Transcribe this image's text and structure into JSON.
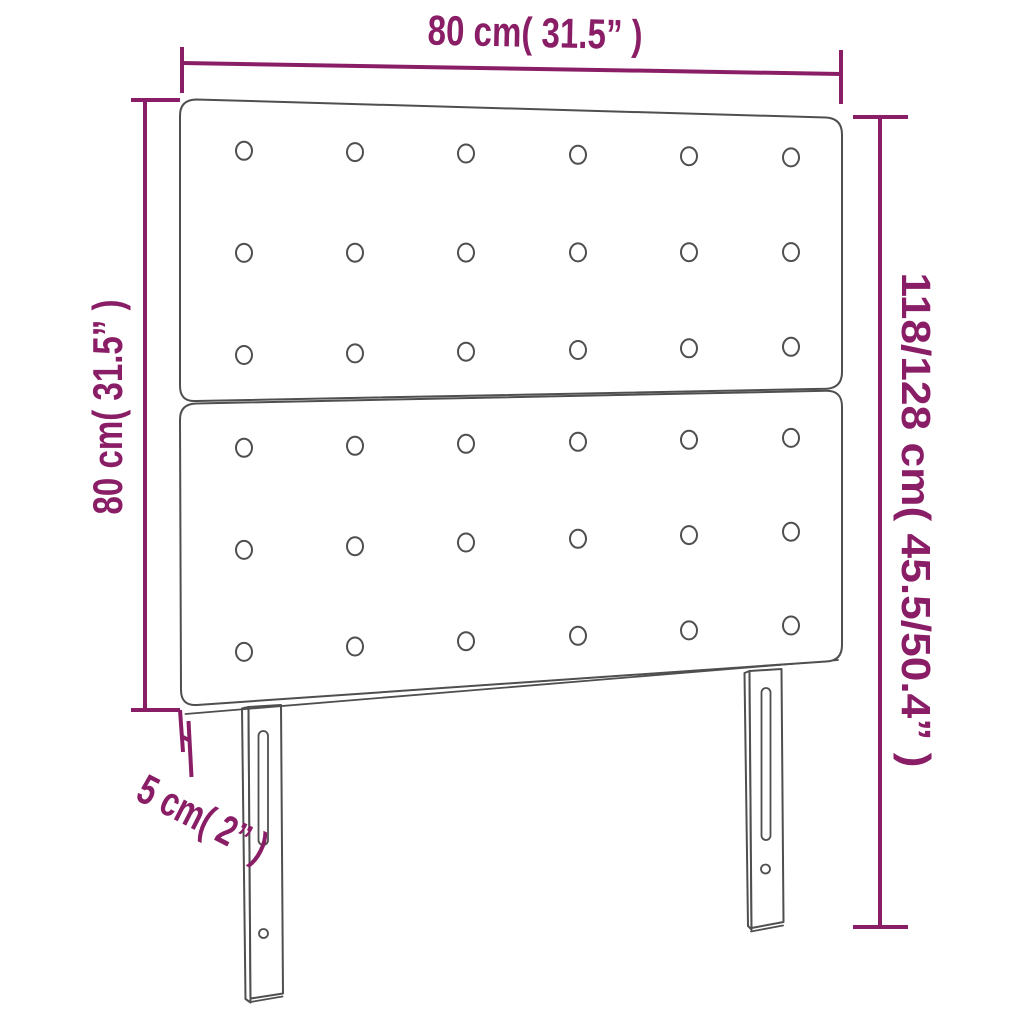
{
  "colors": {
    "dimension_accent": "#8a1e66",
    "outline": "#4f4f4f",
    "background": "#ffffff"
  },
  "dimensions": {
    "width": {
      "label": "80 cm( 31.5” )",
      "position": "top"
    },
    "panel_height": {
      "label": "80 cm( 31.5” )",
      "position": "left"
    },
    "total_height": {
      "label": "118/128 cm( 45.5/50.4” )",
      "position": "right"
    },
    "depth": {
      "label": "5 cm( 2” )",
      "position": "bottom-left"
    }
  },
  "headboard": {
    "panels": [
      {
        "name": "upper-panel",
        "button_rows": 3,
        "button_cols": 6,
        "buttons": 18
      },
      {
        "name": "lower-panel",
        "button_rows": 3,
        "button_cols": 6,
        "buttons": 18
      }
    ],
    "legs": [
      {
        "name": "left-leg",
        "slot": "adjustment-slot",
        "hole": "screw-hole"
      },
      {
        "name": "right-leg",
        "slot": "adjustment-slot",
        "hole": "screw-hole"
      }
    ]
  }
}
